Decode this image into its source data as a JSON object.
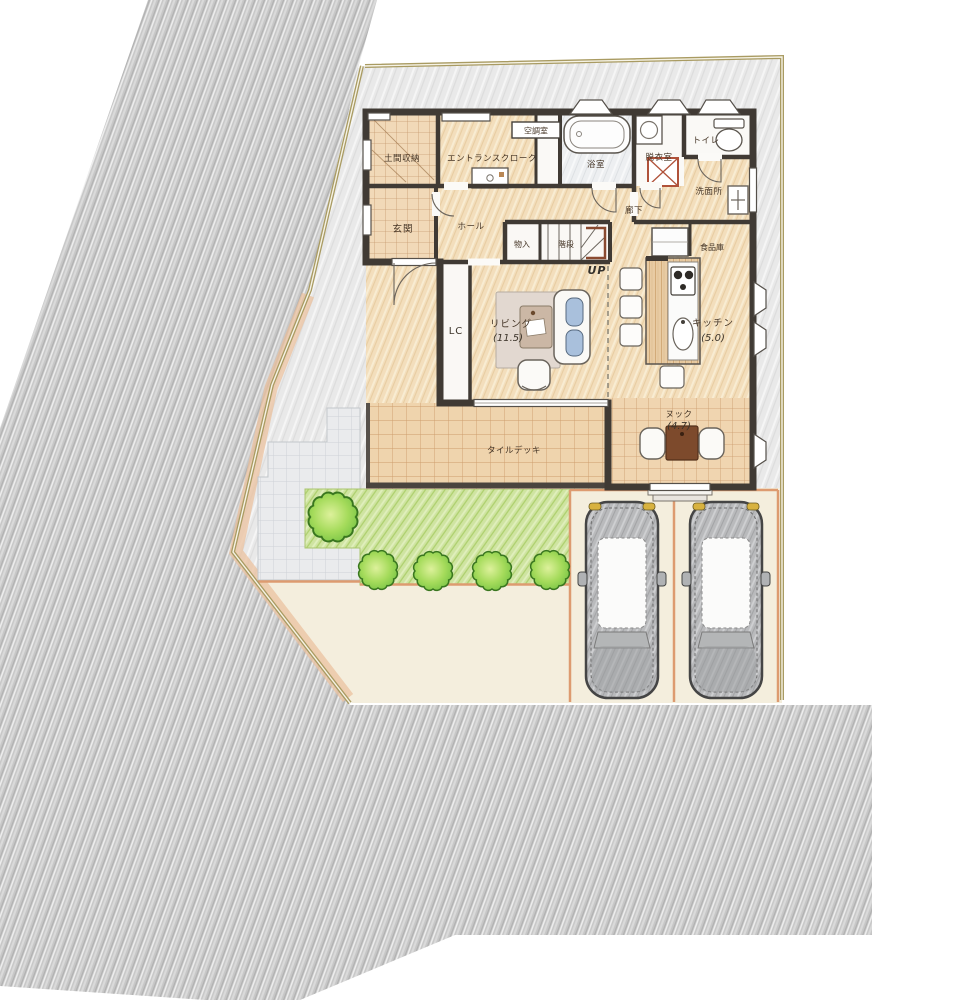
{
  "title": "手描き風 1階平面配置図",
  "labels": {
    "doma": "土間収納",
    "entrance_cloak": "エントランスクローク",
    "ac_room": "空調室",
    "bathroom": "浴室",
    "dressing_room": "脱衣室",
    "toilet": "トイレ",
    "washroom": "洗面所",
    "genkan": "玄関",
    "hall": "ホール",
    "closet": "物入",
    "stairs": "階段",
    "stairs_up": "UP",
    "corridor": "廊下",
    "pantry": "食品庫",
    "living": "リビング",
    "living_size": "(11.5)",
    "living_closet": "LC",
    "kitchen": "キッチン",
    "kitchen_size": "(5.0)",
    "nook": "ヌック",
    "nook_size": "(4.7)",
    "tile_deck": "タイルデッキ"
  },
  "site": {
    "parking_spaces": 2,
    "cars": 2,
    "shrubs": 5
  },
  "colors": {
    "road": "#c9c9c9",
    "site_margin": "#e9e9e9",
    "wood_floor": "#f3ddbb",
    "tile": "#efd4ad",
    "lawn": "#cfe4a1",
    "boundary": "#a99b62",
    "parking_line": "#dd9b70",
    "wall": "#403a34",
    "terrace_wash": "#ebc29f",
    "sofa_cushion": "#a9c0dc",
    "nook_table": "#7d4a2c"
  }
}
